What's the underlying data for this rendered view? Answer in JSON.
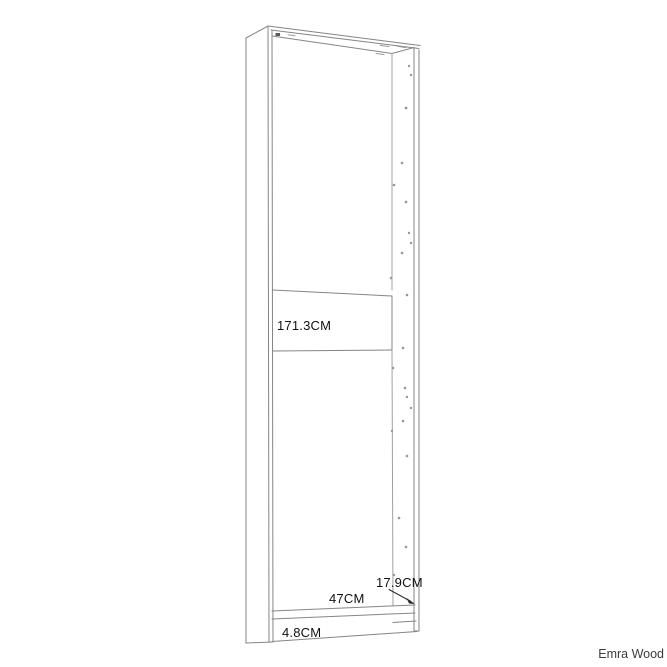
{
  "diagram": {
    "description": "Line drawing of a tall narrow wardrobe/bookcase carcass shown in slight perspective with shelf-pin holes along the right panel",
    "line_color": "#858585",
    "text_color": "#111111",
    "background_color": "#ffffff",
    "dimensions": {
      "height_label": "171.3CM",
      "width_label": "47CM",
      "depth_label": "17.9CM",
      "base_height_label": "4.8CM"
    }
  },
  "brand": {
    "label": "Emra Wood",
    "color": "#3c3c3c"
  }
}
